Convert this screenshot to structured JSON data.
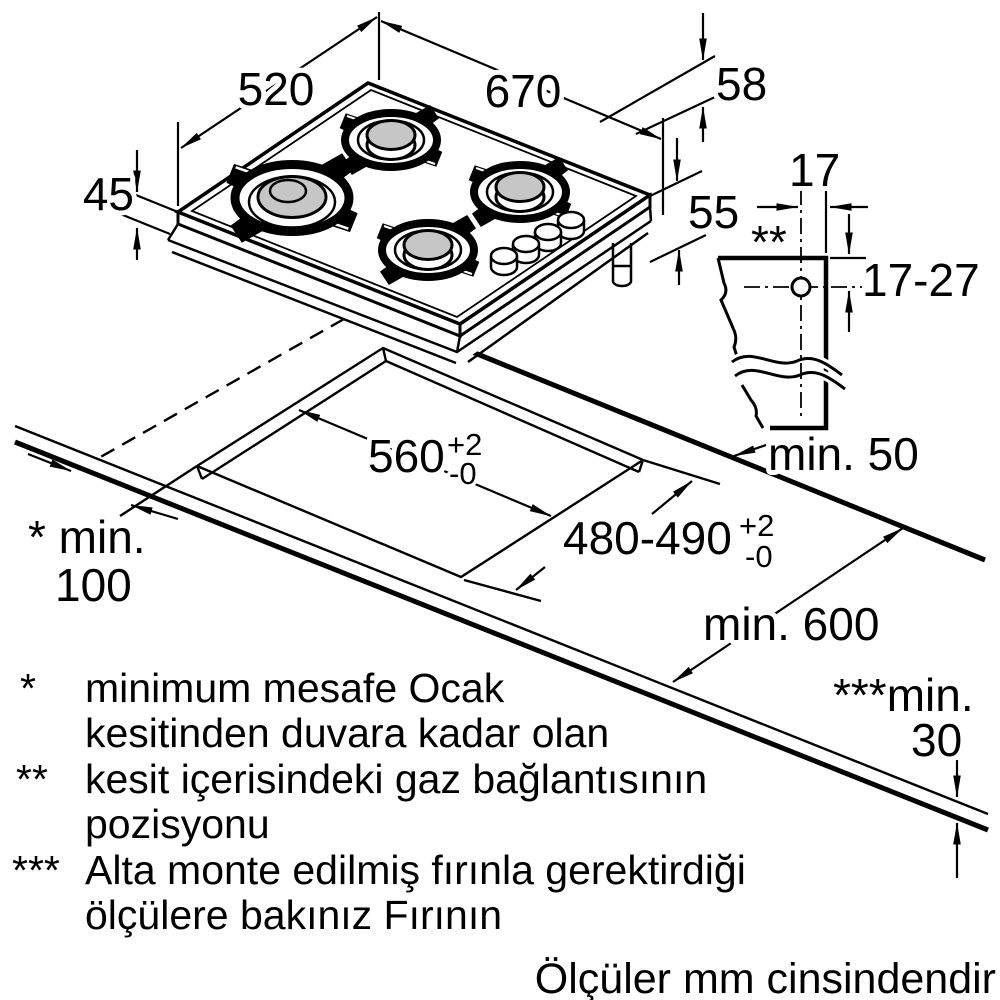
{
  "dims": {
    "hob_width": "670",
    "hob_depth": "520",
    "glass_height": "45",
    "edge_height": "58",
    "body_height": "55",
    "gas_offset": "17",
    "gas_marker": "**",
    "gas_range": "17-27",
    "rear_clearance": "min. 50",
    "cutout_width": "560",
    "cutout_width_tol_up": "+2",
    "cutout_width_tol_down": "-0",
    "cutout_depth": "480-490",
    "cutout_depth_tol_up": "+2",
    "cutout_depth_tol_down": "-0",
    "wall_clearance_line1": "* min.",
    "wall_clearance_line2": "100",
    "worktop_depth": "min. 600",
    "oven_clearance_line1": "***min.",
    "oven_clearance_line2": "30"
  },
  "notes": [
    {
      "marker": "*",
      "line1": "minimum mesafe Ocak",
      "line2": "kesitinden duvara kadar olan"
    },
    {
      "marker": "**",
      "line1": "kesit içerisindeki gaz bağlantısının",
      "line2": "pozisyonu"
    },
    {
      "marker": "***",
      "line1": "Alta monte edilmiş fırınla gerektirdiği",
      "line2": "ölçülere bakınız Fırının"
    }
  ],
  "footer": "Ölçüler mm cinsindendir"
}
